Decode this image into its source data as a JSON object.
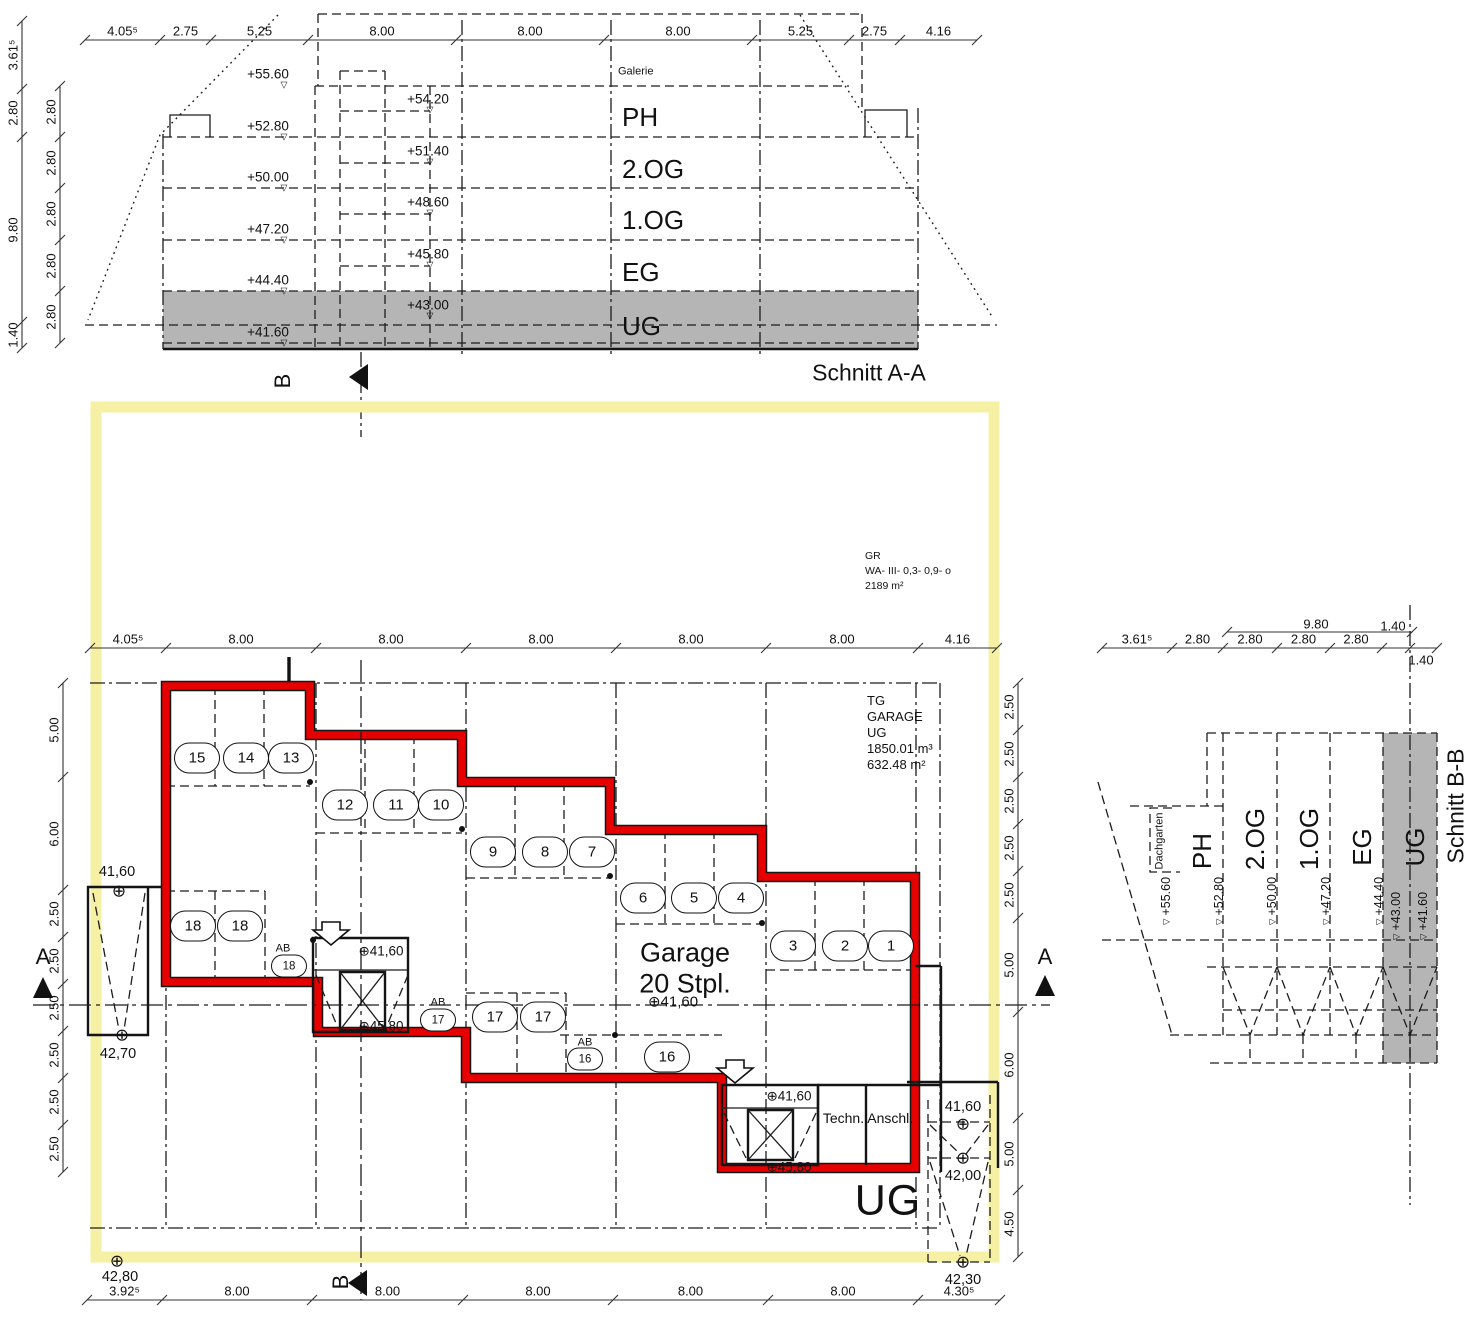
{
  "section_aa": {
    "caption": "Schnitt A-A",
    "galerie": "Galerie",
    "floors": [
      "PH",
      "2.OG",
      "1.OG",
      "EG",
      "UG"
    ],
    "levels_left": [
      "+55.60",
      "+52.80",
      "+50.00",
      "+47.20",
      "+44.40",
      "+41.60"
    ],
    "levels_right": [
      "+54.20",
      "+51.40",
      "+48.60",
      "+45.80",
      "+43.00"
    ],
    "dims_top": [
      "4.05⁵",
      "2.75",
      "5.25",
      "8.00",
      "8.00",
      "8.00",
      "5.25",
      "2.75",
      "4.16"
    ],
    "dims_outer": [
      "3.61⁵",
      "2.80",
      "9.80",
      "1.40"
    ],
    "dims_inner": [
      "2.80",
      "2.80",
      "2.80",
      "2.80",
      "2.80"
    ],
    "marker_b": "B"
  },
  "plan": {
    "dims_top": [
      "4.05⁵",
      "8.00",
      "8.00",
      "8.00",
      "8.00",
      "8.00",
      "4.16"
    ],
    "dims_bottom": [
      "3.92⁵",
      "8.00",
      "8.00",
      "8.00",
      "8.00",
      "8.00",
      "4.30⁵"
    ],
    "dims_left": [
      "5.00",
      "6.00",
      "2.50",
      "2.50",
      "2.50",
      "2.50",
      "2.50",
      "2.50"
    ],
    "dims_right": [
      "2.50",
      "2.50",
      "2.50",
      "2.50",
      "2.50",
      "5.00",
      "6.00",
      "5.00",
      "4.50"
    ],
    "stalls": [
      "15",
      "14",
      "13",
      "12",
      "11",
      "10",
      "9",
      "8",
      "7",
      "6",
      "5",
      "4",
      "3",
      "2",
      "1",
      "18",
      "18",
      "17",
      "17",
      "16"
    ],
    "ab_label": "AB",
    "ab_stalls": [
      "18",
      "17",
      "16"
    ],
    "garage_title": "Garage",
    "garage_subtitle": "20 Stpl.",
    "garage_level": "⊕41,60",
    "stair_levels": [
      "⊕41,60",
      "⊕45,80",
      "⊕41,60",
      "⊕45,80"
    ],
    "tech_room": "Techn. Anschl.",
    "ug_label": "UG",
    "spots": [
      "41,60",
      "42,70",
      "42,80",
      "41,60",
      "42,00",
      "42,30"
    ],
    "zoning": [
      "GR",
      "WA- III- 0,3- 0,9- o",
      "2189 m²"
    ],
    "garage_info": [
      "TG",
      "GARAGE",
      "UG",
      "1850.01 m³",
      "632.48 m²"
    ],
    "marker_a": "A",
    "marker_b": "B"
  },
  "section_bb": {
    "caption": "Schnitt B-B",
    "dachgarten": "Dachgarten",
    "floors": [
      "PH",
      "2.OG",
      "1.OG",
      "EG",
      "UG"
    ],
    "levels": [
      "+55.60",
      "+52.80",
      "+50.00",
      "+47.20",
      "+44.40",
      "+43.00",
      "+41.60"
    ],
    "dim_width": "9.80",
    "dim_wall_a": "1.40",
    "dim_wall_b": "1.40",
    "dims_chain": [
      "3.61⁵",
      "2.80",
      "2.80",
      "2.80",
      "2.80"
    ]
  },
  "symbols": {
    "level_marker": "⊕",
    "triangle_down": "▽"
  },
  "colors": {
    "red": "#e60000",
    "yellow": "#f5f0a3",
    "grey": "#b5b5b5"
  }
}
